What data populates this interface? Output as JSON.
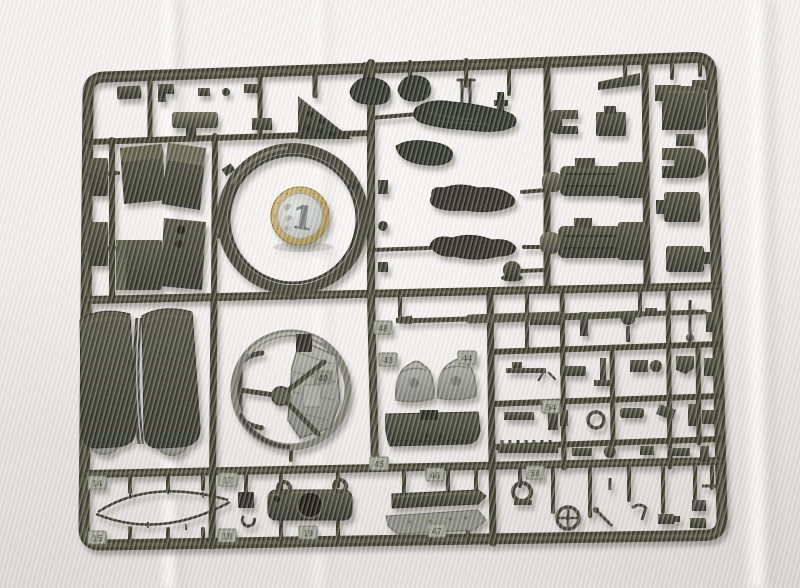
{
  "scene": {
    "type": "photograph",
    "subject": "Olive-drab injection-molded model kit sprue laid on white fabric",
    "description": "A rectangular dark olive-green plastic sprue (parts tree) for a military vehicle model kit, photographed from above on white cloth. A 1 Euro coin is placed inside a large circular ring part for scale. Dozens of small molded parts hang from the runners: stowage bins, crew-figure and tarpaulin castings, gun breech blocks, hatch panels, curved fenders with road wheels, a gun shield ring, a long gun barrel and many tiny fittings."
  },
  "coin": {
    "value": "1",
    "currency": "Euro",
    "ring_color": "#b89c55",
    "center_color": "#c9cbc7"
  },
  "colors": {
    "background_fabric": "#edebe8",
    "plastic_dark": "#2b2d23",
    "plastic_mid": "#3a3c2d",
    "plastic_light": "#5e6049",
    "lit_gray_part": "#8f9187",
    "tag_plate": "#9a9d90",
    "tag_text": "#54574a",
    "molded_mark_plate": "#7d8073",
    "shadow": "rgba(70,68,58,0.45)"
  },
  "part_tags": [
    {
      "label": "48",
      "x": 383,
      "y": 328
    },
    {
      "label": "43",
      "x": 388,
      "y": 360
    },
    {
      "label": "44",
      "x": 467,
      "y": 358
    },
    {
      "label": "54",
      "x": 551,
      "y": 407
    },
    {
      "label": "45",
      "x": 379,
      "y": 464
    },
    {
      "label": "46",
      "x": 435,
      "y": 475
    },
    {
      "label": "47",
      "x": 437,
      "y": 531
    },
    {
      "label": "19",
      "x": 308,
      "y": 533
    },
    {
      "label": "58",
      "x": 535,
      "y": 473
    },
    {
      "label": "14",
      "x": 97,
      "y": 483
    },
    {
      "label": "15",
      "x": 97,
      "y": 538
    },
    {
      "label": "17",
      "x": 228,
      "y": 480
    },
    {
      "label": "18",
      "x": 227,
      "y": 536
    }
  ],
  "molded_marks": [
    {
      "label": "40",
      "x": 323,
      "y": 378
    }
  ],
  "parts_inventory": [
    "stowage boxes and bins",
    "turret race ring with 1 Euro coin inside",
    "tarpaulin rolls and prone crew figures",
    "small arms and tools",
    "two gun breech assemblies",
    "rounded hatch and shield panels",
    "long tapered gun barrel",
    "two curved fenders with road wheels",
    "gun shield ring with sight plate and hand wheel",
    "bell-shaped mount brackets",
    "tow-cable oval of thin rod",
    "cylindrical cradle part with large hole",
    "grid of many tiny detail parts"
  ]
}
